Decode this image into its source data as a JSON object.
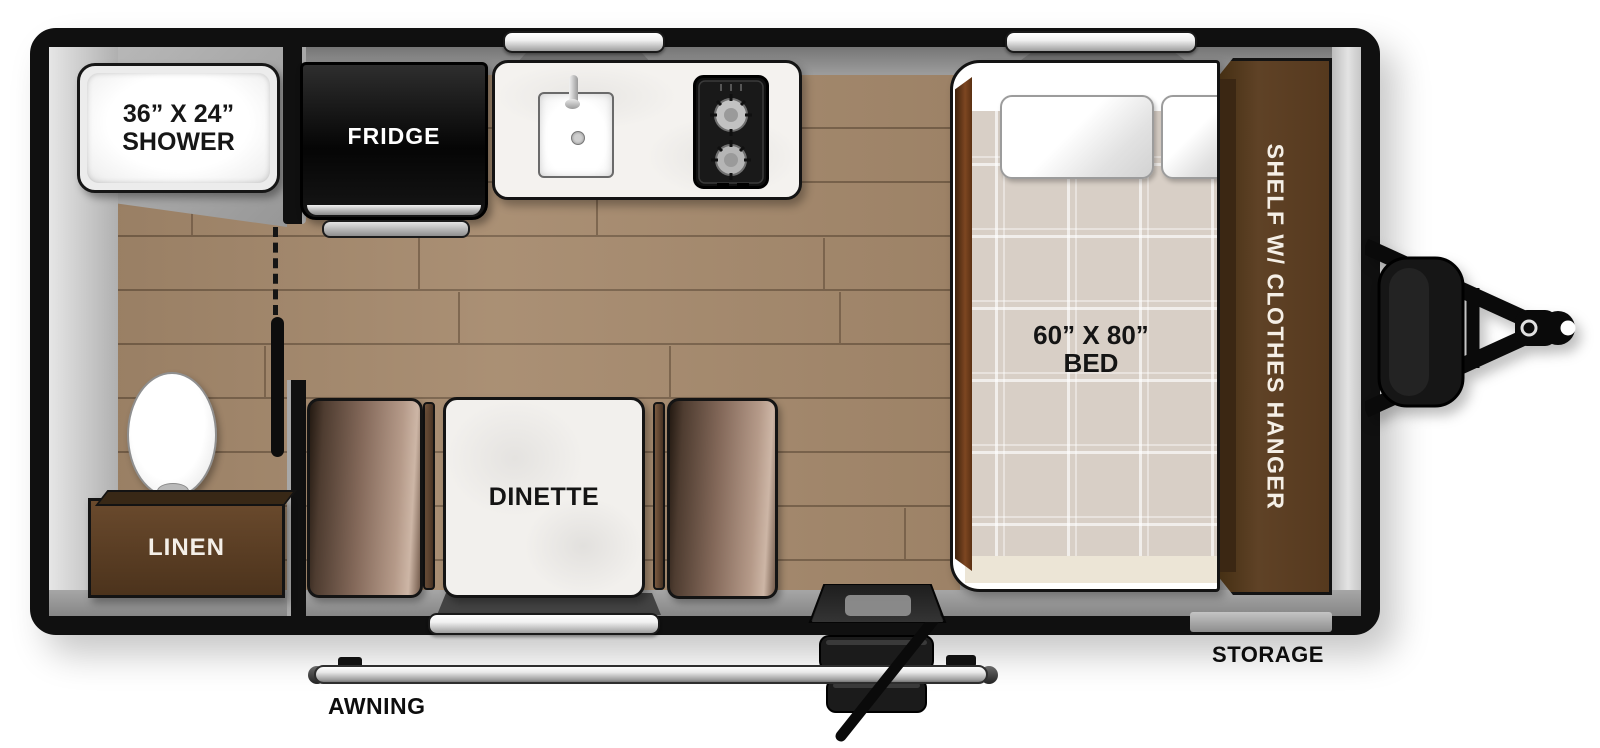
{
  "floorplan": {
    "shower": {
      "size": "36” X 24”",
      "label": "SHOWER"
    },
    "fridge": {
      "label": "FRIDGE"
    },
    "bed": {
      "size": "60” X 80”",
      "label": "BED"
    },
    "shelf": {
      "label": "SHELF W/ CLOTHES HANGER"
    },
    "dinette": {
      "label": "DINETTE"
    },
    "linen": {
      "label": "LINEN"
    },
    "awning": {
      "label": "AWNING"
    },
    "storage": {
      "label": "STORAGE"
    },
    "colors": {
      "wall": "#101010",
      "wood_floor": "#a5896c",
      "plank_line": "#846a4f",
      "subfloor_gray": "#9a9a9a",
      "cabinet_brown": "#5f4226",
      "bench_brown": "#84695a",
      "mattress_tan": "#d8cfc6",
      "counter_white": "#f4f2ef",
      "window_silver": "#e8e8e8"
    }
  }
}
